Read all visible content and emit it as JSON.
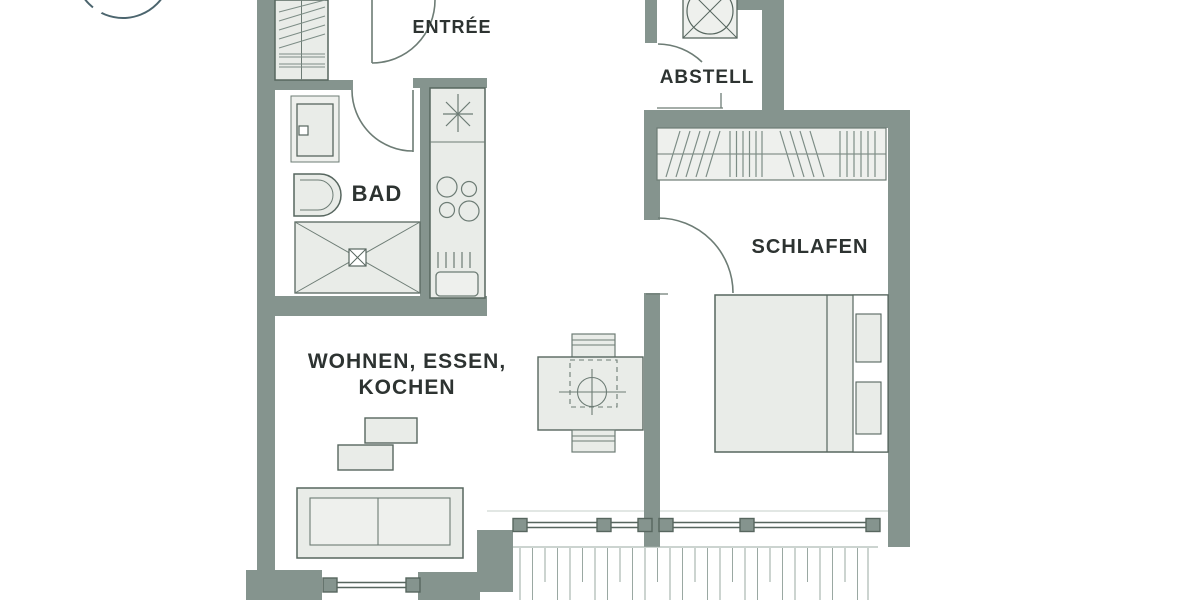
{
  "labels": {
    "entree": "ENTRÉE",
    "abstell": "ABSTELL",
    "bad": "BAD",
    "schlafen": "SCHLAFEN",
    "wohnen_line1": "WOHNEN, ESSEN,",
    "wohnen_line2": "KOCHEN"
  },
  "colors": {
    "wall": "#85948e",
    "furniture_outline": "#57665f",
    "thin_line": "#6d7c75",
    "furniture_fill": "#e9ece8",
    "furniture_fill_light": "#eef0ed",
    "hatch": "#7d8d86",
    "balcony_line": "#9aa8a2",
    "label_text": "#2d3331",
    "logo_arc": "#4c656e",
    "background": "#ffffff"
  }
}
